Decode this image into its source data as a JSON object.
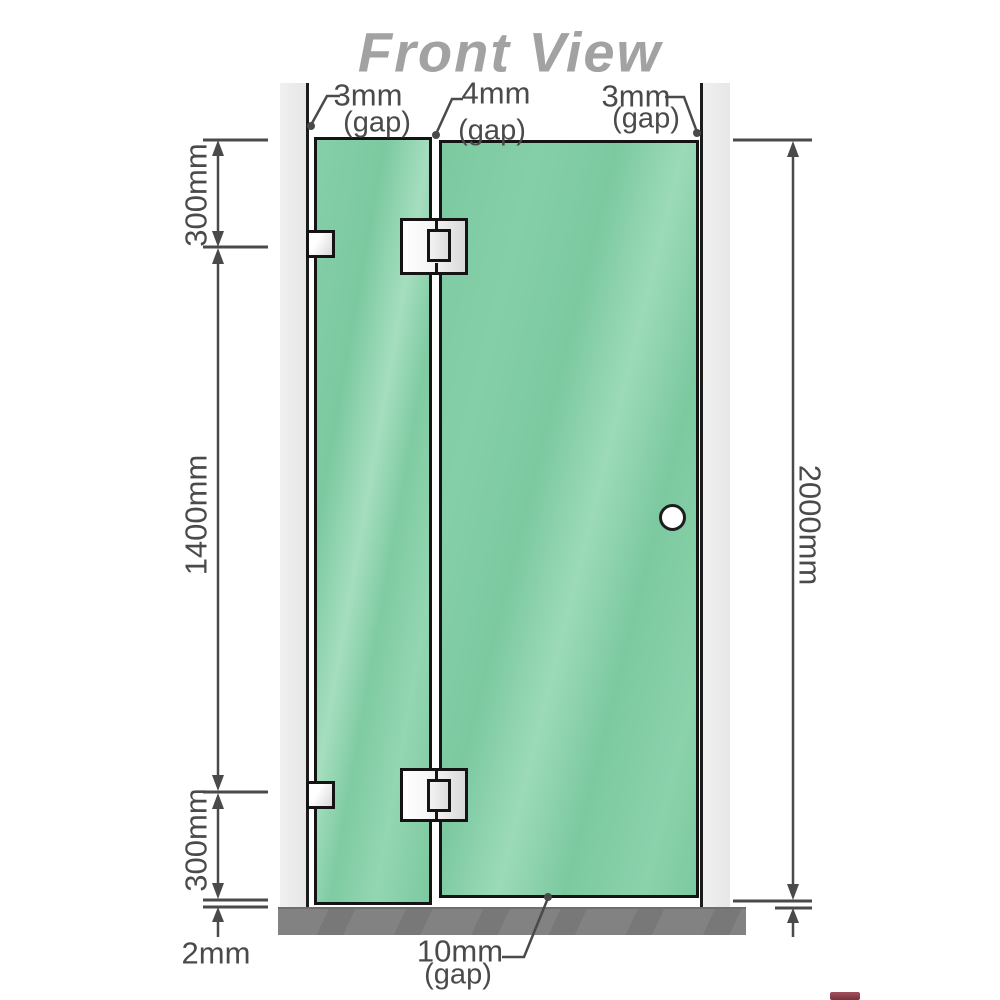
{
  "title": "Front View",
  "gaps": {
    "top_left": {
      "value": "3mm",
      "note": "(gap)"
    },
    "top_middle": {
      "value": "4mm",
      "note": "(gap)"
    },
    "top_right": {
      "value": "3mm",
      "note": "(gap)"
    },
    "bottom_door": {
      "value": "10mm",
      "note": "(gap)"
    },
    "bottom_floor": {
      "value": "2mm"
    }
  },
  "dimensions": {
    "top_hinge_offset": "300mm",
    "hinge_spacing": "1400mm",
    "bottom_hinge_offset": "300mm",
    "overall_height": "2000mm"
  },
  "colors": {
    "glass_green": "#7cc9a0",
    "glass_highlight": "#a5debf",
    "wall_channel_gray": "#ebebeb",
    "floor_gray": "#7d7d7d",
    "dimension_line": "#4a4a4a",
    "title_gray": "#a2a2a2",
    "outline_black": "#141414"
  }
}
